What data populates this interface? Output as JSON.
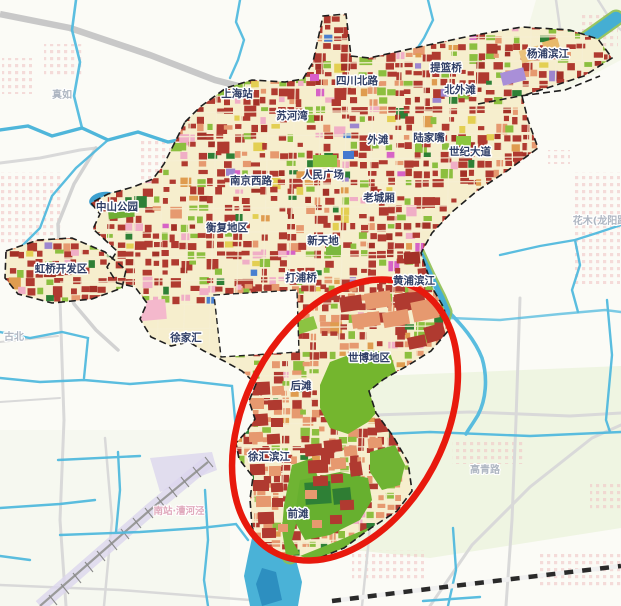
{
  "map": {
    "kind": "shanghai-central-activity-zone-planning-map",
    "highlight": {
      "shape": "ellipse",
      "color": "#e8190d"
    },
    "labels": {
      "districts": [
        {
          "id": "zhenru",
          "text": "真如",
          "x": 62,
          "y": 98,
          "style": "faint"
        },
        {
          "id": "shanghai-station",
          "text": "上海站",
          "x": 237,
          "y": 97,
          "style": "normal"
        },
        {
          "id": "sichuan-north-road",
          "text": "四川北路",
          "x": 357,
          "y": 84,
          "style": "normal"
        },
        {
          "id": "tilanqiao",
          "text": "提篮桥",
          "x": 446,
          "y": 71,
          "style": "normal"
        },
        {
          "id": "north-bund",
          "text": "北外滩",
          "x": 460,
          "y": 93,
          "style": "normal"
        },
        {
          "id": "yangpu-riverside",
          "text": "杨浦滨江",
          "x": 548,
          "y": 57,
          "style": "normal"
        },
        {
          "id": "suhewan",
          "text": "苏河湾",
          "x": 292,
          "y": 119,
          "style": "normal"
        },
        {
          "id": "the-bund",
          "text": "外滩",
          "x": 378,
          "y": 143,
          "style": "normal"
        },
        {
          "id": "lujiazui",
          "text": "陆家嘴",
          "x": 429,
          "y": 141,
          "style": "normal"
        },
        {
          "id": "century-avenue",
          "text": "世纪大道",
          "x": 470,
          "y": 155,
          "style": "normal"
        },
        {
          "id": "nanjing-west-road",
          "text": "南京西路",
          "x": 251,
          "y": 184,
          "style": "normal"
        },
        {
          "id": "peoples-square",
          "text": "人民广场",
          "x": 323,
          "y": 178,
          "style": "normal"
        },
        {
          "id": "zhongshan-park",
          "text": "中山公园",
          "x": 117,
          "y": 210,
          "style": "normal"
        },
        {
          "id": "old-city",
          "text": "老城厢",
          "x": 379,
          "y": 201,
          "style": "normal"
        },
        {
          "id": "hengfu-area",
          "text": "衡复地区",
          "x": 227,
          "y": 231,
          "style": "normal"
        },
        {
          "id": "xintiandi",
          "text": "新天地",
          "x": 323,
          "y": 244,
          "style": "normal"
        },
        {
          "id": "hongqiao-dev-zone",
          "text": "虹桥开发区",
          "x": 61,
          "y": 272,
          "style": "normal"
        },
        {
          "id": "dapuqiao",
          "text": "打浦桥",
          "x": 301,
          "y": 281,
          "style": "normal"
        },
        {
          "id": "huangpu-riverside",
          "text": "黄浦滨江",
          "x": 414,
          "y": 284,
          "style": "normal"
        },
        {
          "id": "xujiahui",
          "text": "徐家汇",
          "x": 186,
          "y": 341,
          "style": "normal"
        },
        {
          "id": "gubei",
          "text": "古北",
          "x": 14,
          "y": 340,
          "style": "faint"
        },
        {
          "id": "expo-area",
          "text": "世博地区",
          "x": 369,
          "y": 361,
          "style": "normal"
        },
        {
          "id": "houtan",
          "text": "后滩",
          "x": 301,
          "y": 389,
          "style": "normal"
        },
        {
          "id": "xuhui-riverside",
          "text": "徐汇滨江",
          "x": 269,
          "y": 460,
          "style": "normal"
        },
        {
          "id": "qiantan",
          "text": "前滩",
          "x": 298,
          "y": 517,
          "style": "normal"
        },
        {
          "id": "south-station-caohejing",
          "text": "南站·漕河泾",
          "x": 179,
          "y": 514,
          "style": "faint-pink"
        },
        {
          "id": "gaoqing-road",
          "text": "高青路",
          "x": 485,
          "y": 473,
          "style": "faint"
        },
        {
          "id": "huamu-longyang",
          "text": "花木(龙阳路",
          "x": 600,
          "y": 224,
          "style": "faint"
        }
      ]
    },
    "colors": {
      "river": "#45aed3",
      "river_bank_green": "#8ebf52",
      "urban_base": "#f6eecd",
      "block_red": "#b03a30",
      "block_dark_red": "#a33127",
      "block_salmon": "#e6996f",
      "block_green": "#8cbf3f",
      "park_green": "#74b62e",
      "park_dark_green": "#2e8036",
      "block_pink": "#f0aec6",
      "block_yellow": "#e3cf52",
      "block_orange": "#df9c4f",
      "block_purple": "#9d86cf",
      "block_magenta": "#d763c6",
      "block_blue": "#4a80d0",
      "boundary": "#222222",
      "highlight_red": "#e8190d",
      "road_gray": "#d6d6d6",
      "label_navy": "#2f3e66"
    }
  }
}
